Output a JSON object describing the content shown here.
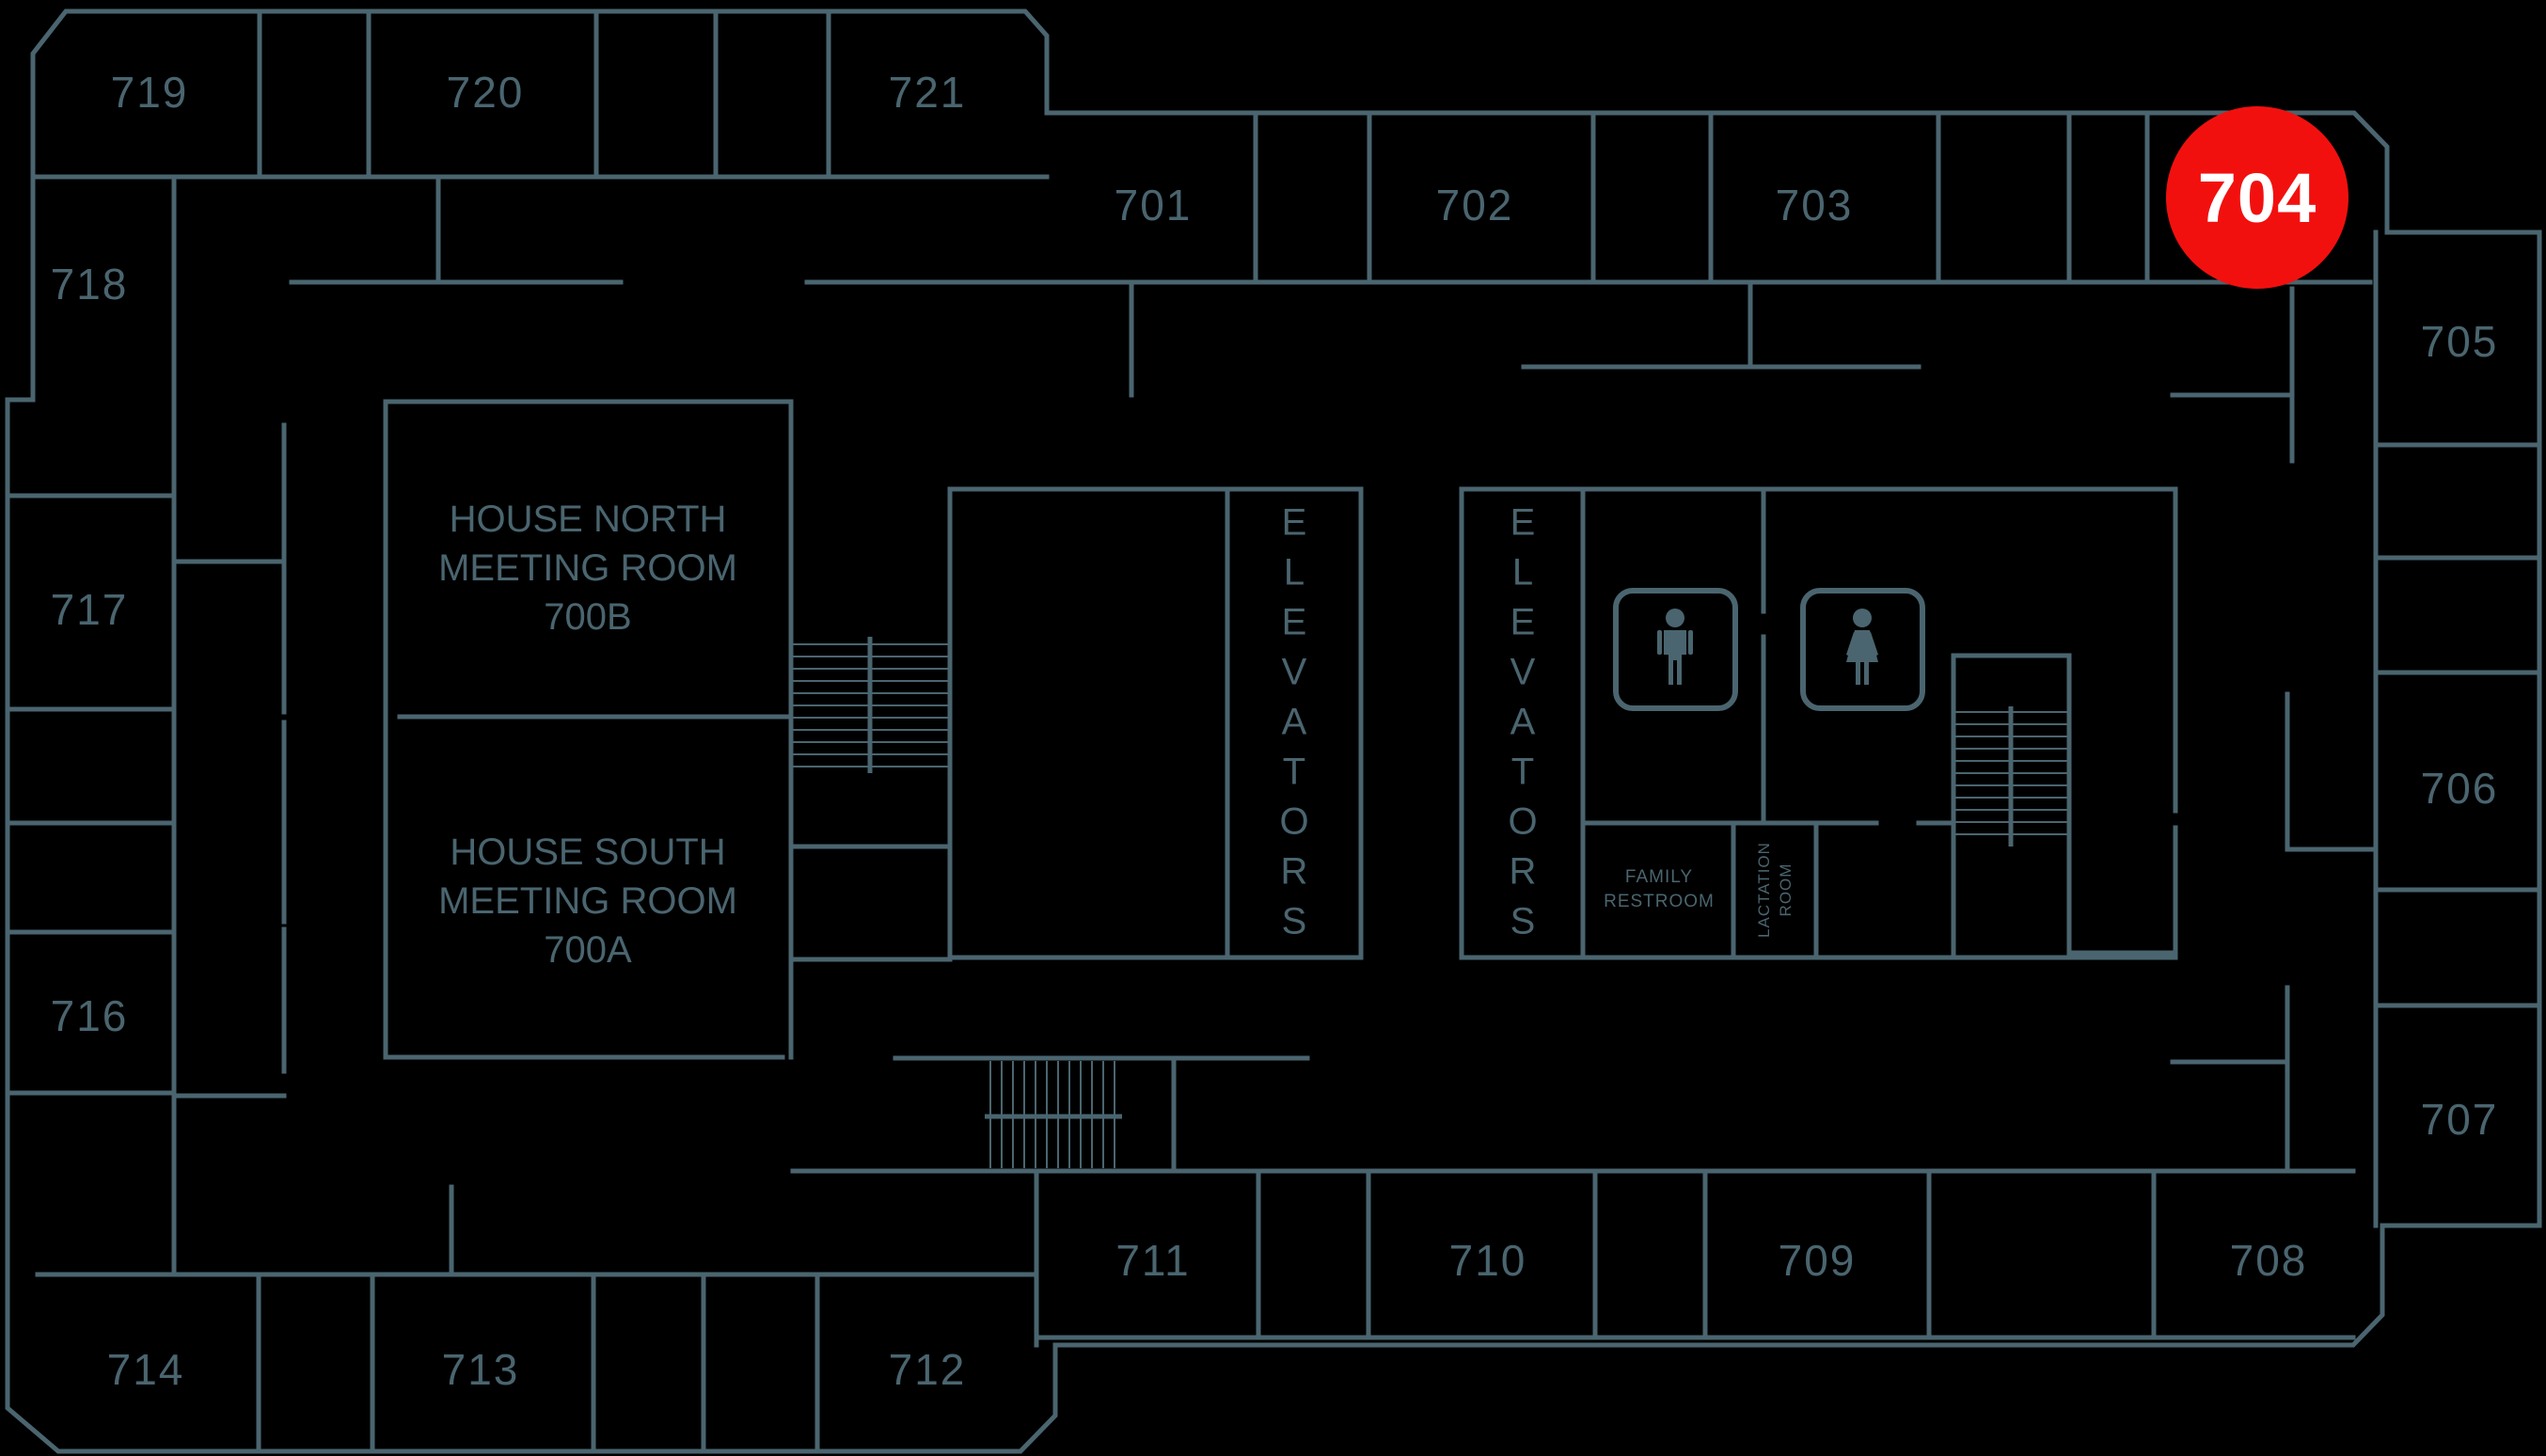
{
  "colors": {
    "background": "#000000",
    "wall": "#4a656f",
    "label": "#4a656f"
  },
  "highlight": {
    "room_number": "704",
    "badge_color": "#f2100f",
    "text_color": "#ffffff"
  },
  "rooms": [
    {
      "number": "719"
    },
    {
      "number": "720"
    },
    {
      "number": "721"
    },
    {
      "number": "718"
    },
    {
      "number": "717"
    },
    {
      "number": "716"
    },
    {
      "number": "714"
    },
    {
      "number": "713"
    },
    {
      "number": "712"
    },
    {
      "number": "701"
    },
    {
      "number": "702"
    },
    {
      "number": "703"
    },
    {
      "number": "705"
    },
    {
      "number": "706"
    },
    {
      "number": "707"
    },
    {
      "number": "708"
    },
    {
      "number": "709"
    },
    {
      "number": "710"
    },
    {
      "number": "711"
    }
  ],
  "meeting_rooms": [
    {
      "lines": [
        "HOUSE NORTH",
        "MEETING ROOM",
        "700B"
      ]
    },
    {
      "lines": [
        "HOUSE SOUTH",
        "MEETING ROOM",
        "700A"
      ]
    }
  ],
  "areas": {
    "elevators": "ELEVATORS",
    "family_restroom_lines": [
      "FAMILY",
      "RESTROOM"
    ],
    "lactation_room_lines": [
      "LACTATION",
      "ROOM"
    ]
  },
  "icons": [
    {
      "name": "male-restroom-icon"
    },
    {
      "name": "female-restroom-icon"
    }
  ]
}
